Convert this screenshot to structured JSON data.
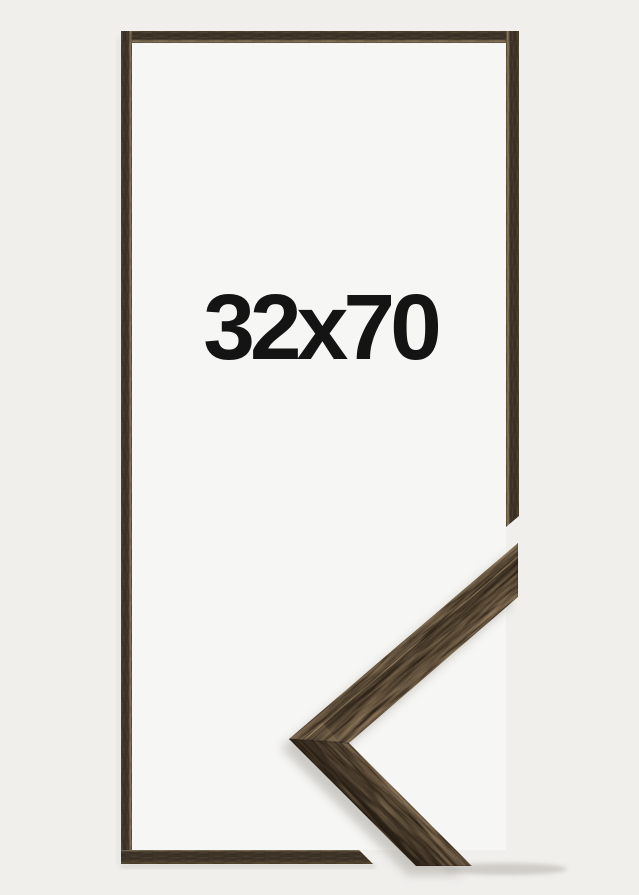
{
  "image": {
    "size_label": "32x70"
  },
  "colors": {
    "background": "#f0efec",
    "opening": "#f6f6f4",
    "text_color": "#141414",
    "frame_dark": "#3e3428",
    "frame_mid": "#53452f",
    "frame_light_edge": "#8a7a5e",
    "wood_base": "#564634",
    "wood_shadow": "#3a2f23",
    "wood_deep": "#251c12",
    "wood_light": "#7c6850",
    "wood_highlight": "#ceb28a"
  }
}
